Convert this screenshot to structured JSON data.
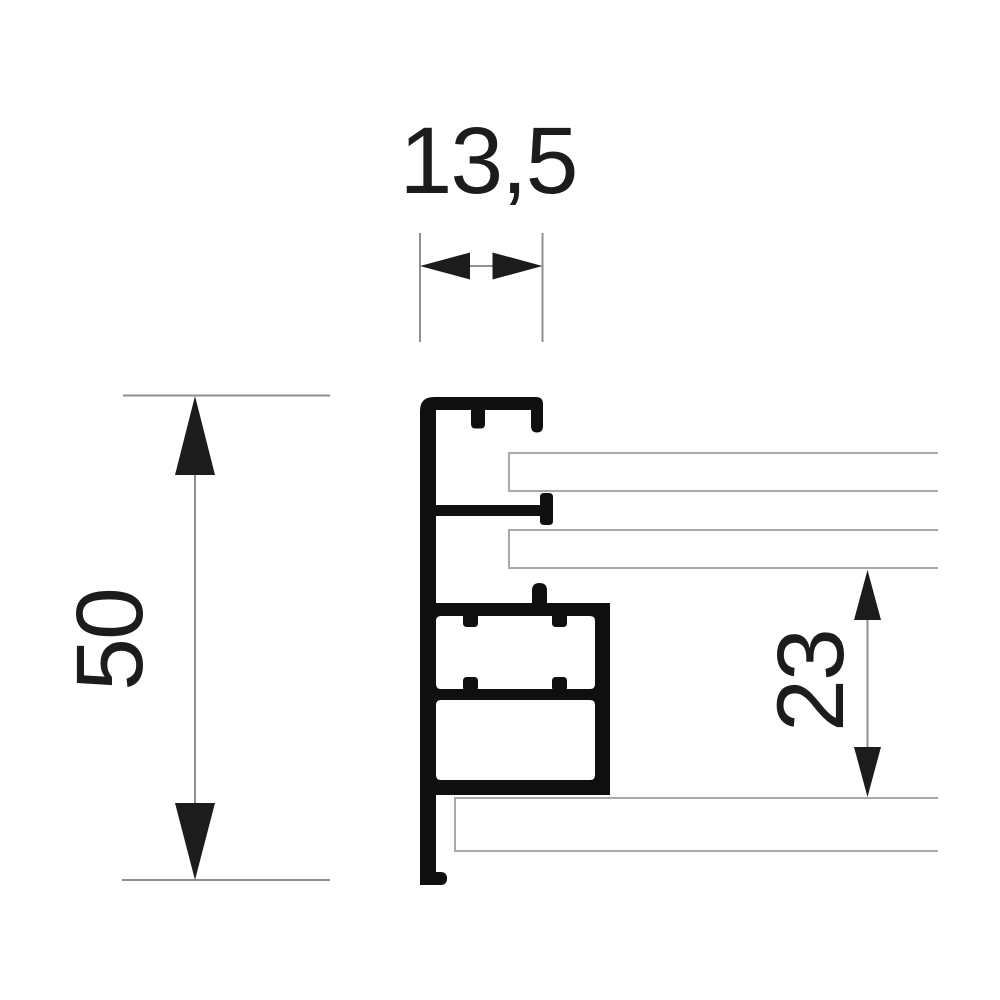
{
  "drawing": {
    "dimensions": {
      "top_width": "13,5",
      "overall_height": "50",
      "right_height": "23"
    },
    "colors": {
      "background": "#ffffff",
      "profile": "#0f0f0f",
      "ink": "#1c1c1c",
      "dim_line": "#8f8f8f",
      "panel_line": "#a9a9a9"
    }
  }
}
